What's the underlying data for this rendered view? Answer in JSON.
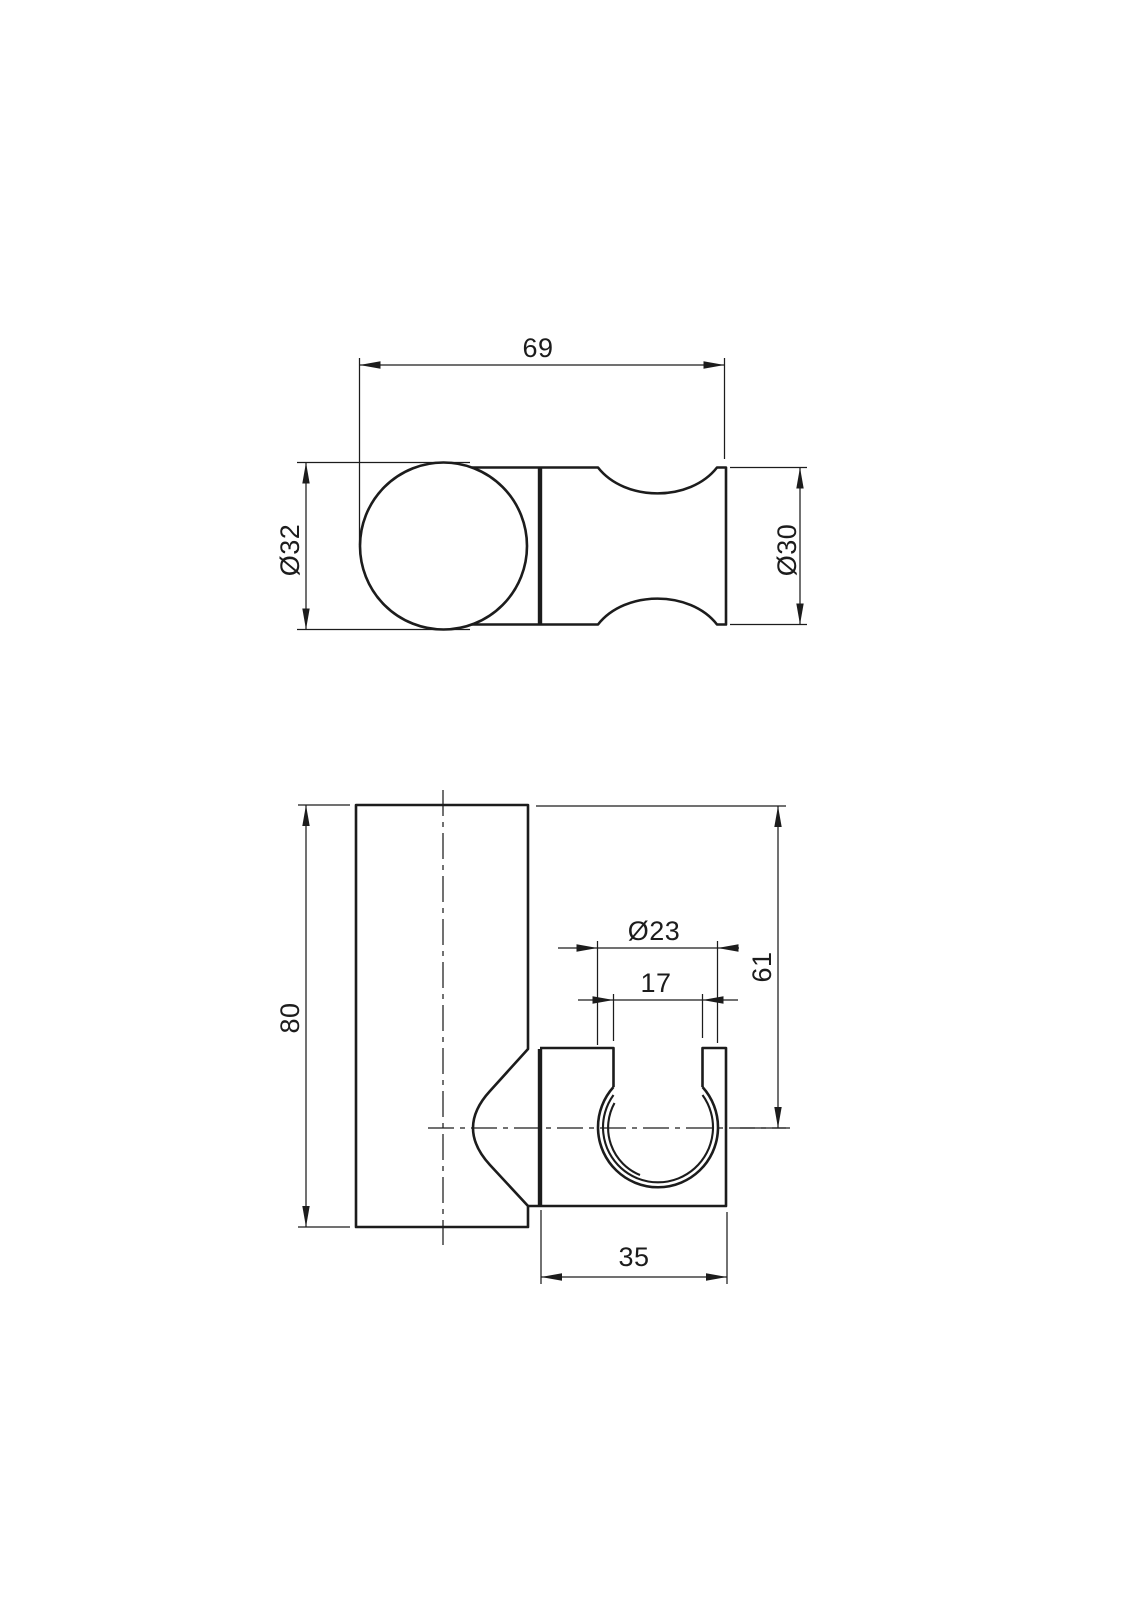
{
  "drawing": {
    "colors": {
      "line": "#1c1c1c",
      "background": "#ffffff"
    },
    "top_view": {
      "dim_width": "69",
      "dim_ball_diameter": "Ø32",
      "dim_body_diameter": "Ø30"
    },
    "front_view": {
      "dim_height": "80",
      "dim_hole_diameter": "Ø23",
      "dim_slot_width": "17",
      "dim_center_height": "61",
      "dim_block_width": "35"
    }
  }
}
